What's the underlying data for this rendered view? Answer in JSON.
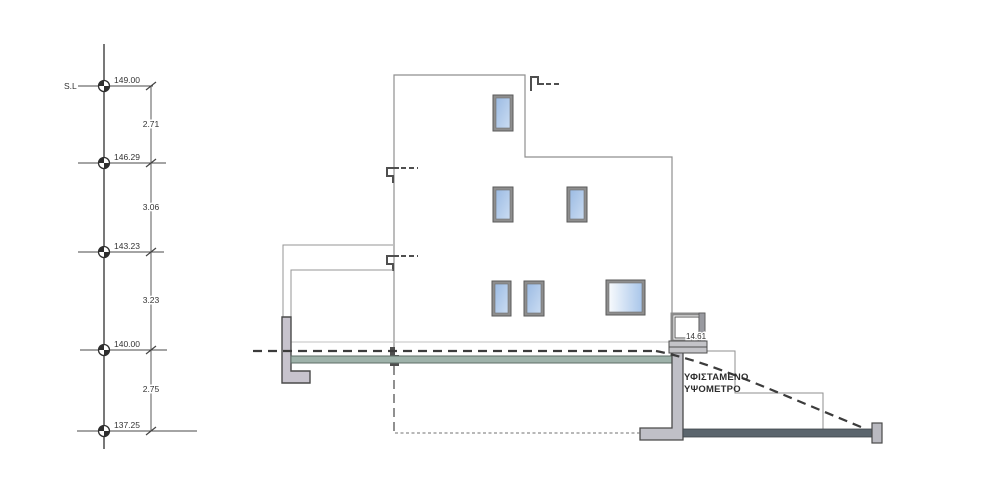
{
  "scale": {
    "datum_label": "S.L",
    "levels": [
      {
        "value": "149.00"
      },
      {
        "value": "146.29"
      },
      {
        "value": "143.23"
      },
      {
        "value": "140.00"
      },
      {
        "value": "137.25"
      }
    ],
    "spans": [
      {
        "value": "2.71"
      },
      {
        "value": "3.06"
      },
      {
        "value": "3.23"
      },
      {
        "value": "2.75"
      }
    ]
  },
  "annotations": {
    "unit_label": "14.61",
    "ground_label_line1": "ΥΦΙΣΤΑΜΕΝΟ",
    "ground_label_line2": "ΥΨΟΜΕΤΡΟ"
  },
  "colors": {
    "outline": "#8f8f8f",
    "dark_detail": "#4f4f4f",
    "dashed_grade": "#3c3c3c",
    "window_glass": "#9cbbe3",
    "window_frame": "#8e8e8e",
    "deck_slab": "#9eb2aa",
    "foundation_slab": "#5b656d",
    "retaining_wall": "#c5c2cb"
  }
}
